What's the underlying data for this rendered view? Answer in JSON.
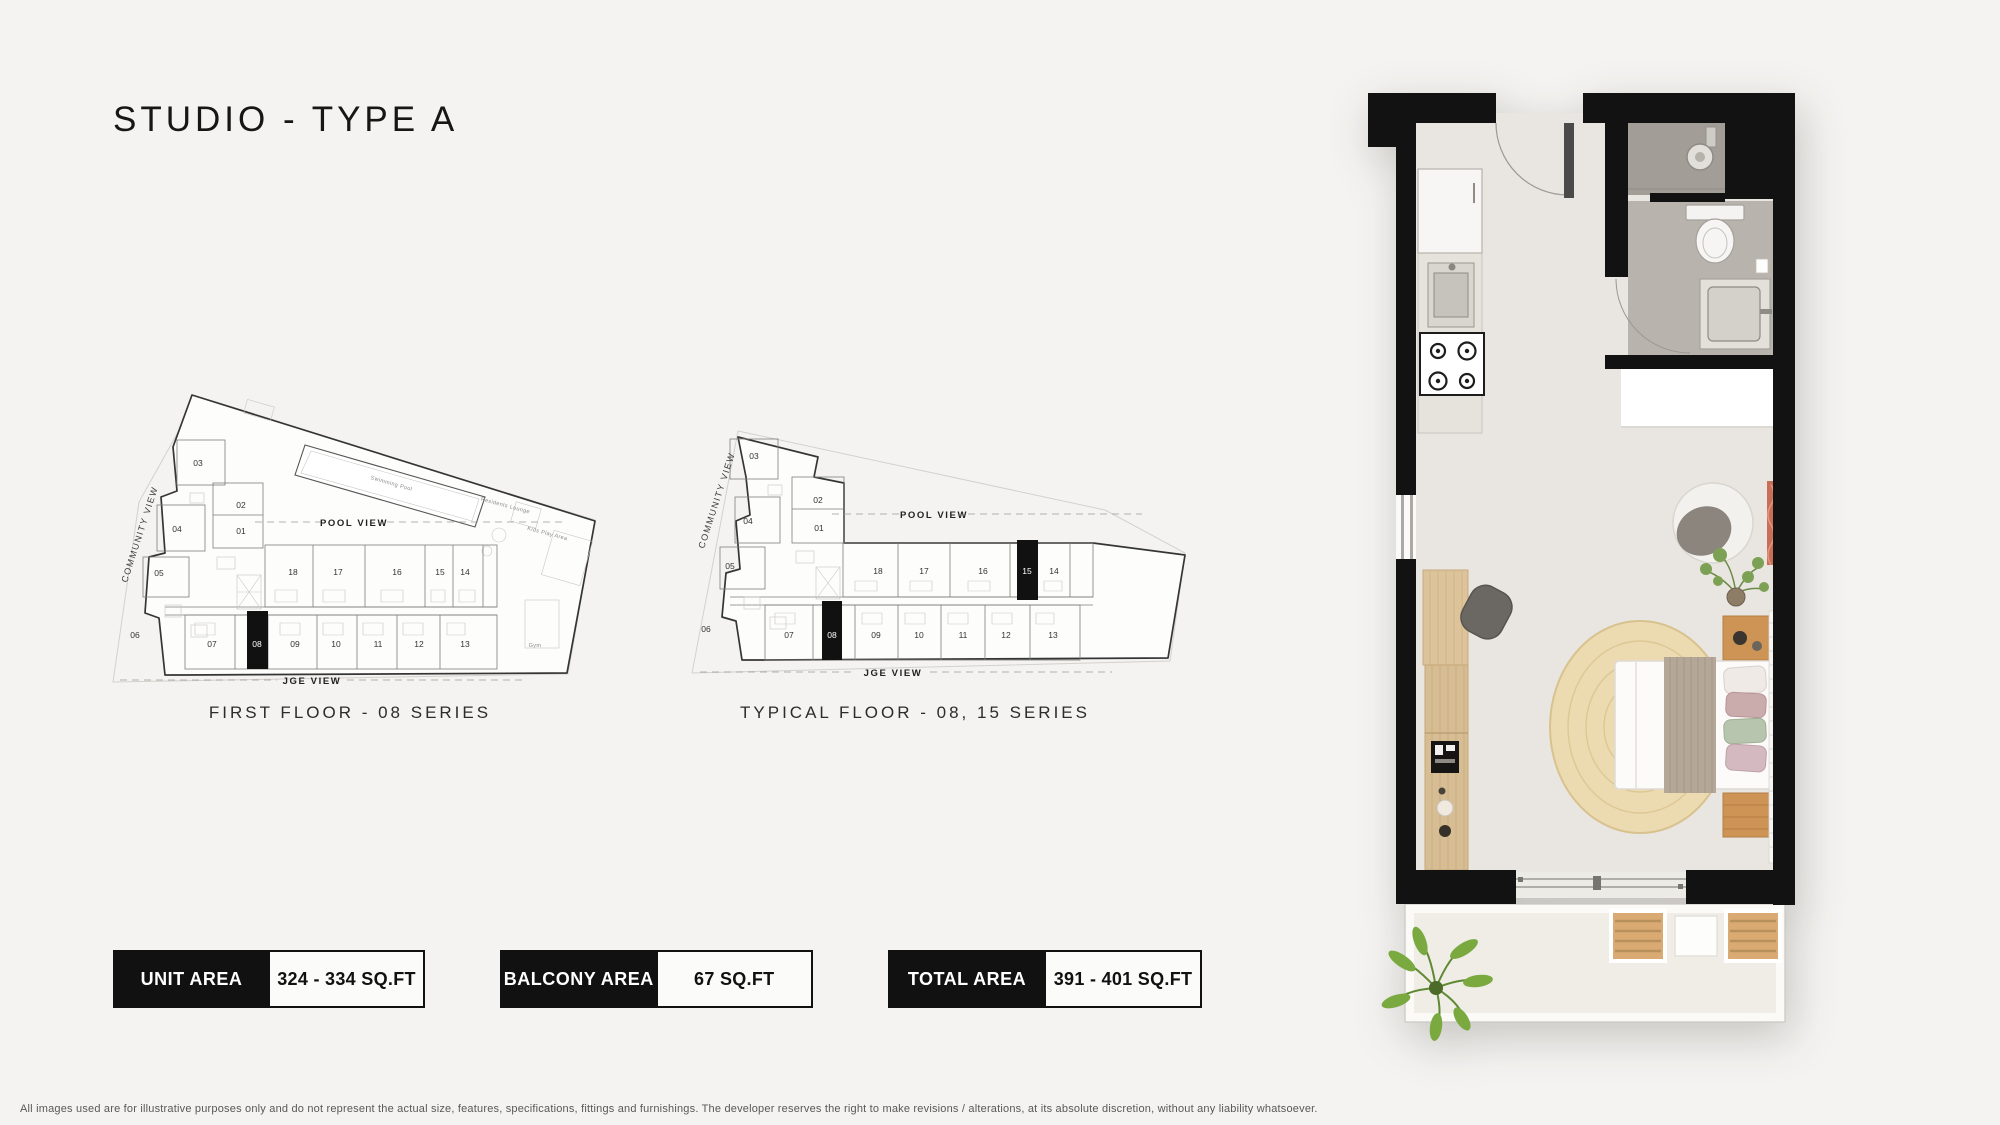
{
  "page": {
    "title": "STUDIO - TYPE A",
    "disclaimer": "All images used are for illustrative purposes only and do not represent the actual size, features, specifications, fittings and furnishings. The developer reserves the right to make revisions / alterations, at its absolute discretion, without any liability whatsoever."
  },
  "colors": {
    "page_bg": "#f4f3f1",
    "wall_black": "#121212",
    "floor": "#e9e6e1",
    "bathroom_floor": "#b8b3ac",
    "shower_floor": "#a29d96",
    "wood": "#d2b084",
    "nightstand_wood": "#cd9455",
    "rug": "#ecdbb1",
    "balcony_floor": "#f0ede7",
    "coral_curtain": "#c96f58"
  },
  "plans": [
    {
      "caption": "FIRST FLOOR - 08 SERIES",
      "highlighted_units": [
        "08"
      ],
      "units": [
        "01",
        "02",
        "03",
        "04",
        "05",
        "06",
        "07",
        "08",
        "09",
        "10",
        "11",
        "12",
        "13",
        "14",
        "15",
        "16",
        "17",
        "18"
      ],
      "labels": {
        "community_view": "COMMUNITY VIEW",
        "pool_view": "POOL VIEW",
        "jge_view": "JGE VIEW",
        "swimming_pool": "Swimming Pool",
        "residents_lounge": "Residents Lounge",
        "kids_play_area": "Kids Play Area",
        "gym": "Gym"
      }
    },
    {
      "caption": "TYPICAL FLOOR - 08, 15 SERIES",
      "highlighted_units": [
        "08",
        "15"
      ],
      "units": [
        "01",
        "02",
        "03",
        "04",
        "05",
        "06",
        "07",
        "08",
        "09",
        "10",
        "11",
        "12",
        "13",
        "14",
        "15",
        "16",
        "17",
        "18"
      ],
      "labels": {
        "community_view": "COMMUNITY VIEW",
        "pool_view": "POOL VIEW",
        "jge_view": "JGE VIEW"
      }
    }
  ],
  "area_boxes": [
    {
      "label": "UNIT AREA",
      "value": "324 - 334 SQ.FT"
    },
    {
      "label": "BALCONY AREA",
      "value": "67 SQ.FT"
    },
    {
      "label": "TOTAL AREA",
      "value": "391 - 401 SQ.FT"
    }
  ]
}
